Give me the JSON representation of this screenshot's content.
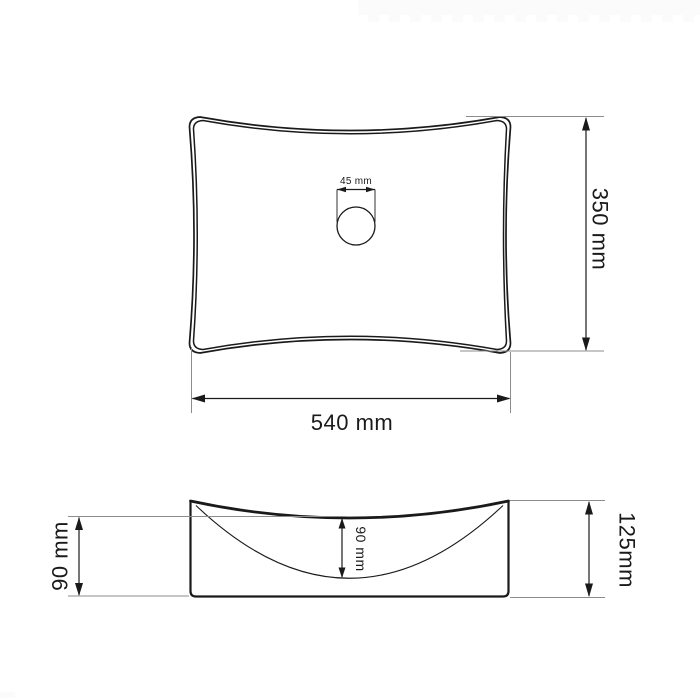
{
  "colors": {
    "line": "#1a1a1a",
    "extension": "#8c8c8c",
    "background": "#ffffff",
    "watermark": "#fbfbfb"
  },
  "top_view": {
    "width_label": "540 mm",
    "height_label": "350 mm",
    "drain_label": "45 mm"
  },
  "side_view": {
    "outer_depth_label": "90 mm",
    "inner_depth_label": "90 mm",
    "total_height_label": "125mm"
  }
}
